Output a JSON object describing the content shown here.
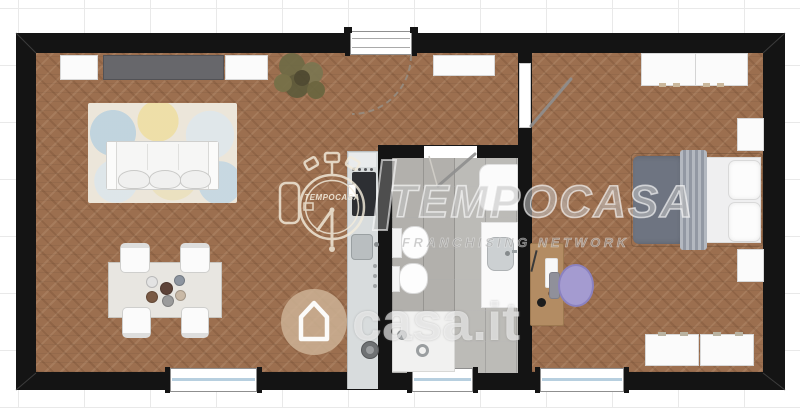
{
  "watermarks": {
    "tempocasa": {
      "logo_icon": "stopwatch-icon",
      "logo_text": "TEMPOCASA",
      "brand": "TEMPOCASA",
      "tagline": "FRANCHISING NETWORK"
    },
    "casait": {
      "icon": "house-icon",
      "text": "casa.it"
    }
  },
  "floorplan": {
    "rooms": [
      "living-room-with-kitchen",
      "bathroom",
      "bedroom"
    ],
    "openings": [
      "entrance-door",
      "bedroom-door",
      "bathroom-door",
      "window-living",
      "window-bathroom",
      "window-bedroom"
    ],
    "furniture": [
      "sofa",
      "area-rug",
      "tv-sideboard",
      "storage-cabinet-left",
      "storage-cabinet-right",
      "wall-console",
      "plant",
      "dining-table",
      "dining-chairs",
      "plates",
      "kitchen-counter",
      "cooktop",
      "kitchen-sink",
      "washing-machine",
      "toilet",
      "bidet",
      "vanity-sink",
      "shower",
      "wardrobe",
      "double-bed",
      "nightstands",
      "desk",
      "desk-chair",
      "dresser"
    ]
  },
  "colors": {
    "wall": "#141414",
    "parquet_floor": "#9c6f4f",
    "bathroom_tile": "#b2b0ac",
    "kitchen_counter": "#d8dcdd",
    "sideboard_gray": "#67676b",
    "bed_duvet": "#6e7481",
    "desk_wood": "#b38c63",
    "chair_lavender": "#a49bd0",
    "casait_badge": "#cdb294",
    "window_glass": "#b7cfdf",
    "background": "#ffffff",
    "grid_line": "#e9e9e9"
  }
}
